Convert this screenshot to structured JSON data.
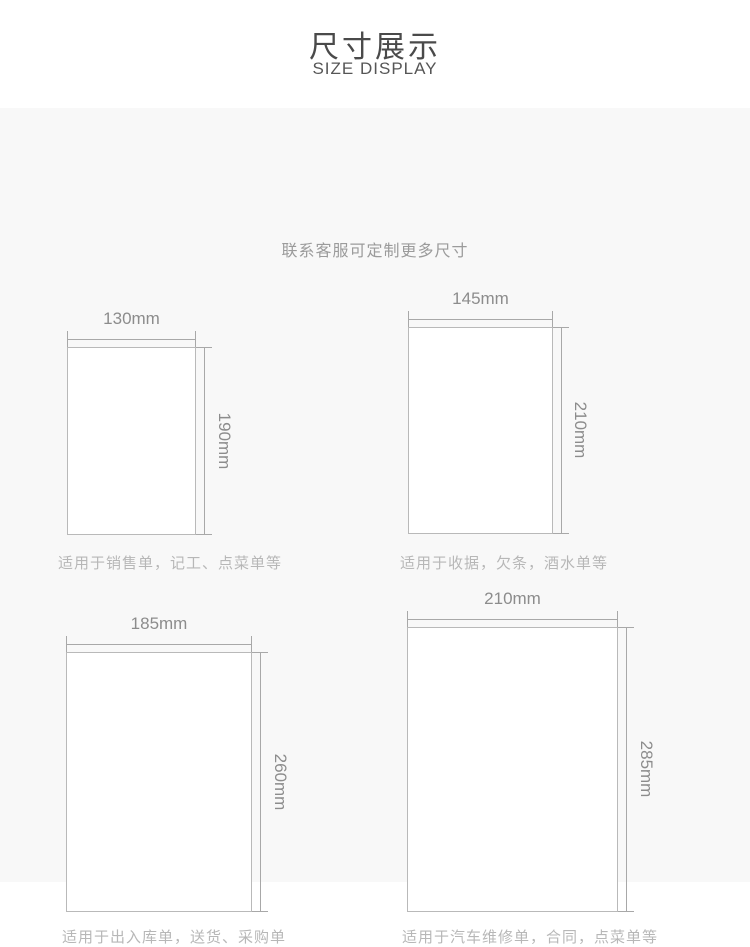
{
  "header": {
    "title": "尺寸展示",
    "subtitle": "SIZE DISPLAY"
  },
  "note": "联系客服可定制更多尺寸",
  "panels": [
    {
      "width_label": "130mm",
      "height_label": "190mm",
      "description": "适用于销售单，记工、点菜单等"
    },
    {
      "width_label": "145mm",
      "height_label": "210mm",
      "description": "适用于收据，欠条，酒水单等"
    },
    {
      "width_label": "185mm",
      "height_label": "260mm",
      "description": "适用于出入库单，送货、采购单"
    },
    {
      "width_label": "210mm",
      "height_label": "285mm",
      "description": "适用于汽车维修单，合同，点菜单等"
    }
  ],
  "colors": {
    "section_background": "#f8f8f8",
    "line": "#a8a8a8",
    "rect_border": "#b9b9b9",
    "title_text": "#4a4a4a",
    "note_text": "#9b9b9b",
    "dimension_text": "#8c8c8c",
    "description_text": "#b7b7b7"
  }
}
